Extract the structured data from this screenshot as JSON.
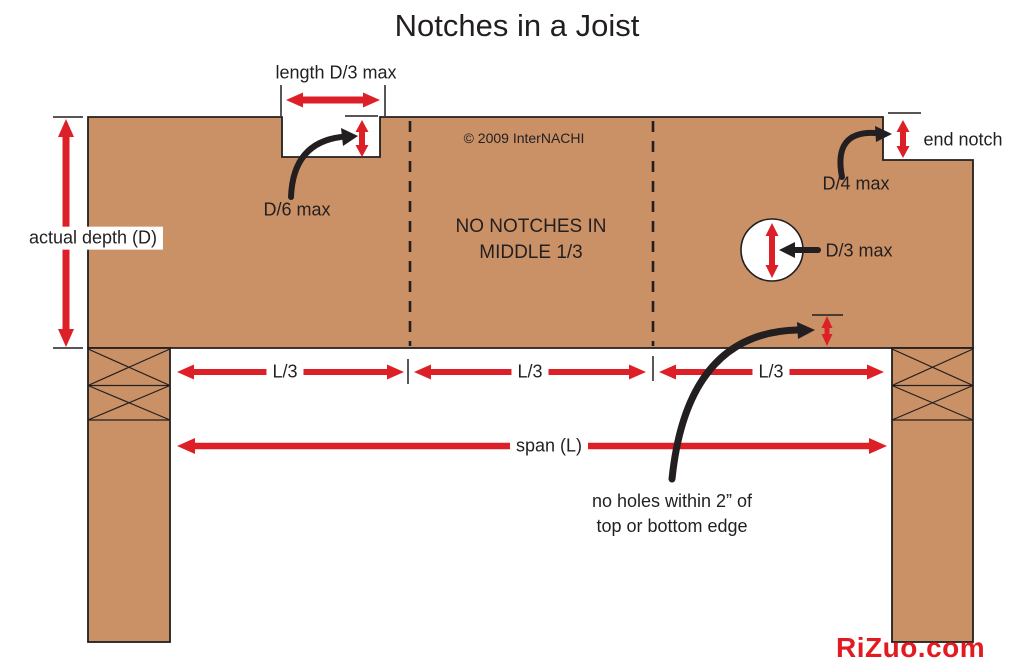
{
  "title": "Notches in a Joist",
  "copyright": "© 2009 InterNACHI",
  "watermark": "RiZuo.com",
  "colors": {
    "wood": "#CA9166",
    "ink": "#231F20",
    "red": "#DD2027",
    "watermark_red": "#E21B22",
    "bg": "#FFFFFF"
  },
  "labels": {
    "notch_length": "length D/3 max",
    "notch_depth": "D/6 max",
    "actual_depth": "actual depth (D)",
    "no_notches": "NO NOTCHES IN\nMIDDLE 1/3",
    "end_notch": "end notch",
    "end_notch_depth": "D/4 max",
    "hole_diameter": "D/3 max",
    "l3_left": "L/3",
    "l3_middle": "L/3",
    "l3_right": "L/3",
    "span": "span (L)",
    "no_holes": "no holes within 2” of\ntop or bottom edge"
  }
}
